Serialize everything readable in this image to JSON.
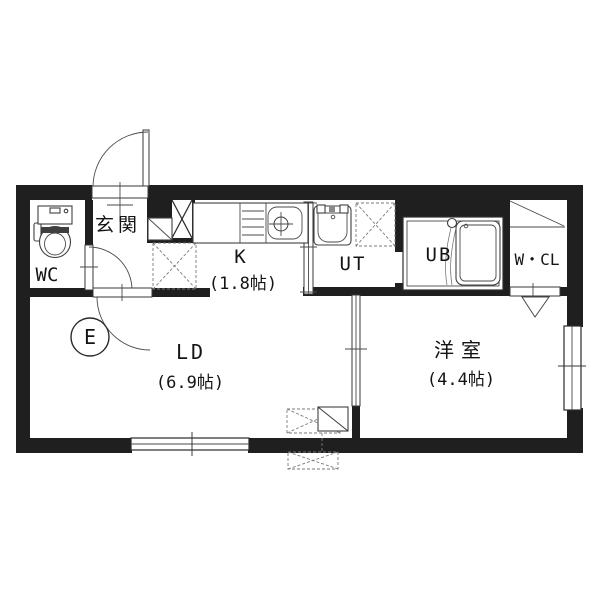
{
  "plan": {
    "title": "1LDK apartment floor plan",
    "rooms": {
      "genkan": {
        "label": "玄関"
      },
      "wc": {
        "label": "WC"
      },
      "kitchen": {
        "label": "K",
        "size": "(1.8帖)"
      },
      "utility": {
        "label": "UT"
      },
      "bath": {
        "label": "UB"
      },
      "closet": {
        "label": "W・CL"
      },
      "living": {
        "label": "LD",
        "size": "(6.9帖)"
      },
      "bedroom": {
        "label": "洋室",
        "size": "(4.4帖)"
      },
      "mark_e": {
        "label": "E"
      }
    },
    "fixtures": [
      "toilet",
      "kitchen-counter",
      "gas-stove",
      "kitchen-sink",
      "washbasin",
      "washing-machine-space",
      "bathtub",
      "shoe-cabinet",
      "refrigerator-space",
      "closet-shelf",
      "air-conditioner",
      "ac-outdoor-unit",
      "pillar-cross",
      "entrance-door",
      "wc-door",
      "ld-door",
      "bath-door",
      "closet-door",
      "sliding-door-kitchen-ut",
      "sliding-door-ld-bedroom",
      "window-ld",
      "window-bedroom"
    ],
    "colors": {
      "wall": "#1f1f1f",
      "line": "#3c3c3c",
      "background": "#ffffff",
      "text": "#141414"
    }
  }
}
